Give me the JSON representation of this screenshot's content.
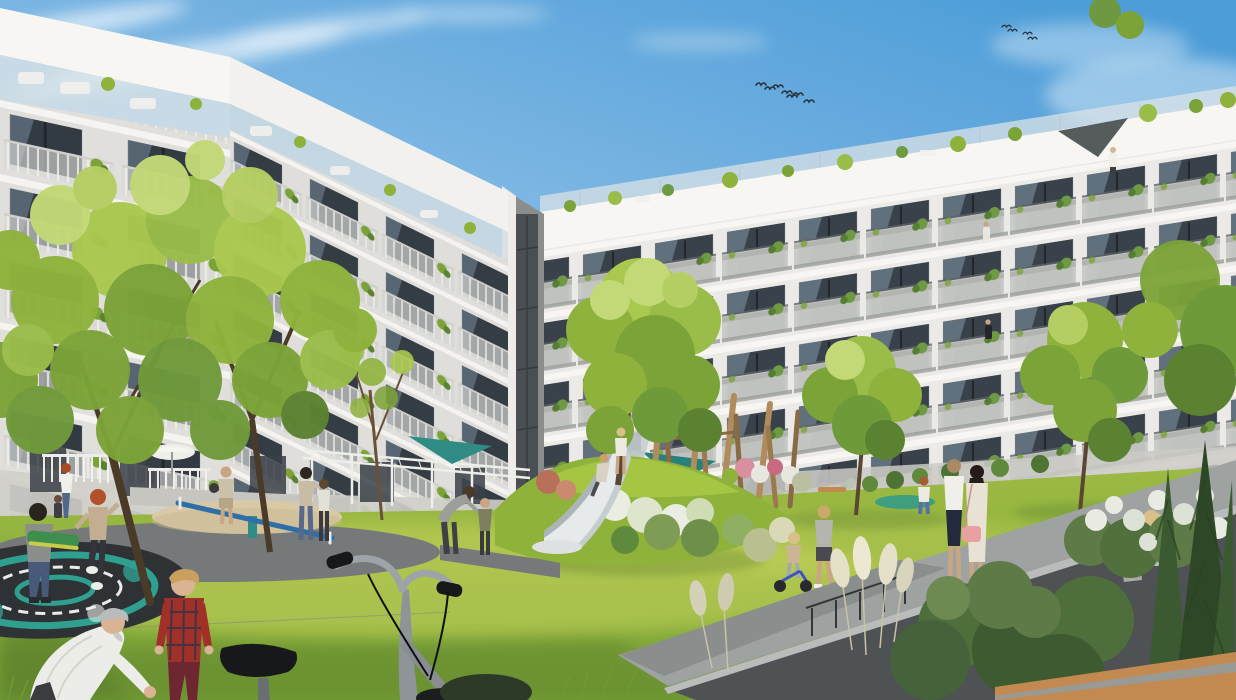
{
  "scene": {
    "type": "architectural-rendering",
    "description": "Sunny residential courtyard rendering: two modern white apartment wings with plant-filled balconies frame a green lawn with playground (steel slide on a mound, blue seesaw, in-ground trampoline, wooden climbing poles, pergola with teal shade sails), trees, and many residents; a silver bicycle, an elderly man and a boy in a red plaid shirt are in the foreground; birds fly in a blue sky.",
    "time_of_day": "daytime, clear blue sky with wispy clouds",
    "setting": "apartment courtyard with playground and landscaped garden"
  },
  "buildings": {
    "left_wing": {
      "description": "white apartment wing receding from left edge toward center, rooftop terraces with glass railings, balconies with white slat railings and plants",
      "floors_visible": 7
    },
    "right_wing": {
      "description": "long white apartment wing receding to the right, gray balcony fronts, floor-to-ceiling glazing, rooftop terraces with plants and a dark shade sail",
      "floors_visible": 6
    },
    "junction": {
      "description": "dark recessed stairwell glazing where the two wings meet"
    }
  },
  "playground": {
    "slide": "stainless-steel embankment slide on a grassy mound with white flowering shrubs",
    "seesaw": "blue steel seesaw over a sand circle",
    "trampoline": "in-ground trampoline with teal and white pattern",
    "climbing_poles": "cluster of slanted wooden robinia poles",
    "pergola": "white pergola with teal triangular shade sails",
    "parasol": "white garden parasol near left terraces",
    "bench": "small wooden bench by the right lawn"
  },
  "people": [
    {
      "id": "elderly-man",
      "where": "foreground bottom left",
      "detail": "gray-haired man in white shirt bending forward"
    },
    {
      "id": "plaid-boy",
      "where": "foreground left",
      "detail": "blond boy in red plaid shirt and dark red trousers"
    },
    {
      "id": "skateboard-boy",
      "where": "left lawn",
      "detail": "boy carrying a green skateboard"
    },
    {
      "id": "redhead-girl",
      "where": "on trampoline",
      "detail": "red-haired girl in beige top stepping"
    },
    {
      "id": "redhead-woman-child",
      "where": "left terrace edge",
      "detail": "red-haired woman walking with a toddler"
    },
    {
      "id": "sand-man",
      "where": "sand circle",
      "detail": "man in tan clothes carrying a dark bag"
    },
    {
      "id": "center-woman-girl",
      "where": "center lawn",
      "detail": "dark-haired woman in beige top with jeans touching a girl's head"
    },
    {
      "id": "crouch-pair",
      "where": "center lawn",
      "detail": "adult in gray bending toward a child in an olive jacket"
    },
    {
      "id": "slide-kids",
      "where": "slide",
      "detail": "one child sliding down, one standing at the top"
    },
    {
      "id": "toddler-trike",
      "where": "right path",
      "detail": "toddler on a small blue balance trike"
    },
    {
      "id": "walking-boy",
      "where": "right path",
      "detail": "boy in gray t-shirt walking"
    },
    {
      "id": "mound-kid",
      "where": "teal play mound",
      "detail": "child in white top and jeans"
    },
    {
      "id": "women-pair",
      "where": "right walkway",
      "detail": "woman in white blouse and navy skirt beside woman in cream dress with pink crossbody bag"
    },
    {
      "id": "sitting-blonde",
      "where": "bottom right among hydrangeas",
      "detail": "blonde woman in gray sitting"
    },
    {
      "id": "roof-person",
      "where": "right wing rooftop terrace",
      "detail": "tiny standing figure"
    },
    {
      "id": "balcony-person",
      "where": "right wing balcony",
      "detail": "tiny figure at railing"
    }
  ],
  "birds": {
    "flocks": 2,
    "total": 11
  },
  "foreground": {
    "bicycle": "silver city bicycle with black saddle and grips, seen from behind",
    "bench_slab": "light concrete bench in bottom-right corner",
    "conifers": "dark columnar conifers and shrubs in bottom-right corner",
    "pampas": "cream pampas-grass plumes along the retaining wall",
    "wall": "dark gray retaining wall with walkway running diagonally to the right"
  },
  "colors": {
    "sky_top": "#4D9DD8",
    "sky_mid": "#8FC0E8",
    "sky_horizon": "#DCEAF5",
    "cloud": "#FFFFFF",
    "facade_sun": "#EBEAE6",
    "facade_far": "#E0DFDB",
    "fascia": "#F7F6F2",
    "window": "#39414B",
    "window_reflect": "#93A9BB",
    "balcony": "#C7C9C5",
    "glass_rail": "#D9E2E6",
    "stairwell": "#4A4F53",
    "lawn_top": "#9CBA44",
    "lawn_bottom": "#76A035",
    "lawn_sunband": "#CBD65E",
    "lawn_shadow": "#5E822E",
    "foliage_light": "#C3D877",
    "foliage": "#9ABD4A",
    "foliage_mid": "#7CA338",
    "foliage_dark": "#5B8230",
    "conifer": "#3C5A31",
    "trunk": "#5A4632",
    "gravel": "#75797A",
    "walkway": "#9EA2A0",
    "wall": "#4E5254",
    "sand": "#D9C9A6",
    "tramp_base": "#2E3234",
    "tramp_teal": "#2FA090",
    "seesaw_blue": "#2E6FA8",
    "slide_bed": "#E7EAEB",
    "slide_rail": "#ABB4B8",
    "pole_wood": "#B08B5C",
    "pergola_white": "#EFEFEA",
    "sail_teal": "#2E8C84",
    "pampas": "#E5E0C8",
    "hydrangea": "#E9EBE3",
    "bench_wood": "#C28A50",
    "bag_pink": "#E8A0A0",
    "plaid_red": "#A03028",
    "skateboard_green": "#3E8E4E",
    "bike_metal": "#9DA3A6",
    "saddle_black": "#17181A"
  }
}
